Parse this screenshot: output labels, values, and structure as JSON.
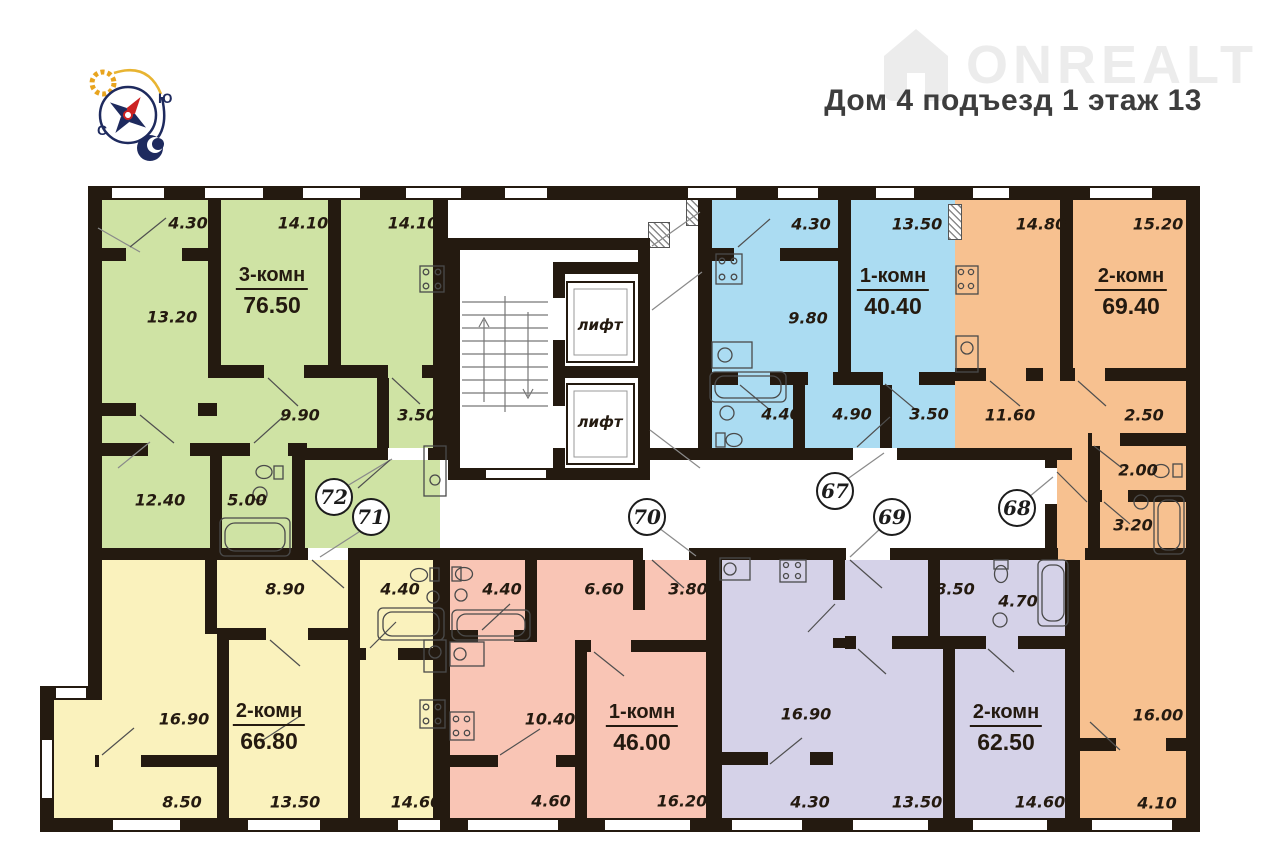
{
  "header": {
    "brand": "ONREALT",
    "title": "Дом 4 подъезд 1 этаж 13",
    "compass": {
      "south_label": "Ю",
      "north_label": "С"
    }
  },
  "floorplan": {
    "elevator_label": "лифт",
    "wall_color": "#241a10",
    "apartments": [
      {
        "number": "72",
        "type": "3-комн",
        "area": "76.50",
        "color": "#cfe3a4",
        "rooms": [
          "4.30",
          "14.10",
          "14.10",
          "13.20",
          "9.90",
          "3.50",
          "12.40",
          "5.00"
        ]
      },
      {
        "number": "67",
        "type": "1-комн",
        "area": "40.40",
        "color": "#abdcf2",
        "rooms": [
          "4.30",
          "13.50",
          "9.80",
          "4.40",
          "4.90",
          "3.50"
        ]
      },
      {
        "number": "68",
        "type": "2-комн",
        "area": "69.40",
        "color": "#f7c190",
        "rooms": [
          "14.80",
          "15.20",
          "11.60",
          "2.50",
          "2.00",
          "3.20",
          "16.00",
          "4.10"
        ]
      },
      {
        "number": "71",
        "type": "2-комн",
        "area": "66.80",
        "color": "#faf2bd",
        "rooms": [
          "8.90",
          "4.40",
          "16.90",
          "8.50",
          "13.50",
          "14.60"
        ]
      },
      {
        "number": "70",
        "type": "1-комн",
        "area": "46.00",
        "color": "#f9c5b5",
        "rooms": [
          "4.40",
          "6.60",
          "3.80",
          "10.40",
          "4.60",
          "16.20"
        ]
      },
      {
        "number": "69",
        "type": "2-комн",
        "area": "62.50",
        "color": "#d5d2e8",
        "rooms": [
          "8.50",
          "4.70",
          "16.90",
          "4.30",
          "13.50",
          "14.60"
        ]
      }
    ]
  }
}
